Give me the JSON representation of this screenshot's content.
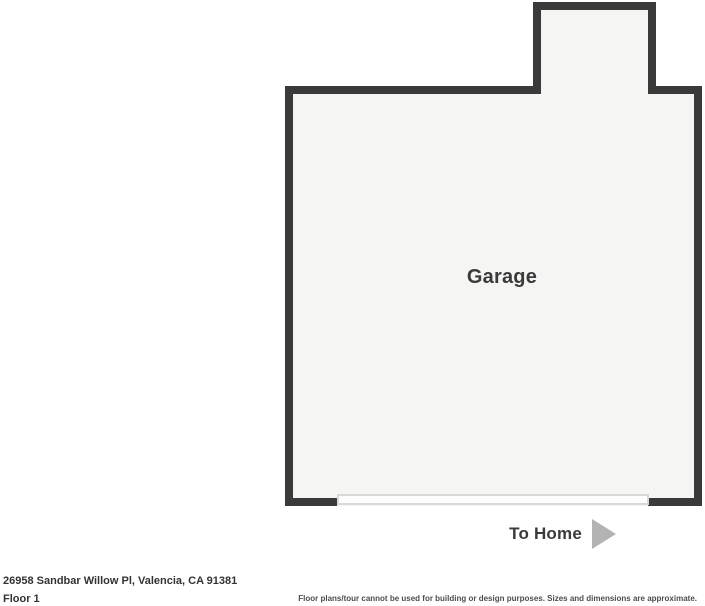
{
  "floorplan": {
    "room_label": "Garage",
    "to_home": {
      "label": "To Home",
      "arrow_icon": "right-arrow-icon"
    }
  },
  "footer": {
    "address": "26958 Sandbar Willow Pl, Valencia, CA 91381",
    "floor_label": "Floor 1",
    "disclaimer": "Floor plans/tour cannot be used for building or design purposes. Sizes and dimensions are approximate."
  },
  "colors": {
    "wall": "#3a3a3a",
    "room_fill": "#f5f5f4",
    "door_line": "#d8d8d8",
    "arrow": "#b3b3b3",
    "text_dark": "#3a3a3a",
    "text_footer": "#333333",
    "text_muted": "#4d4d4d"
  }
}
